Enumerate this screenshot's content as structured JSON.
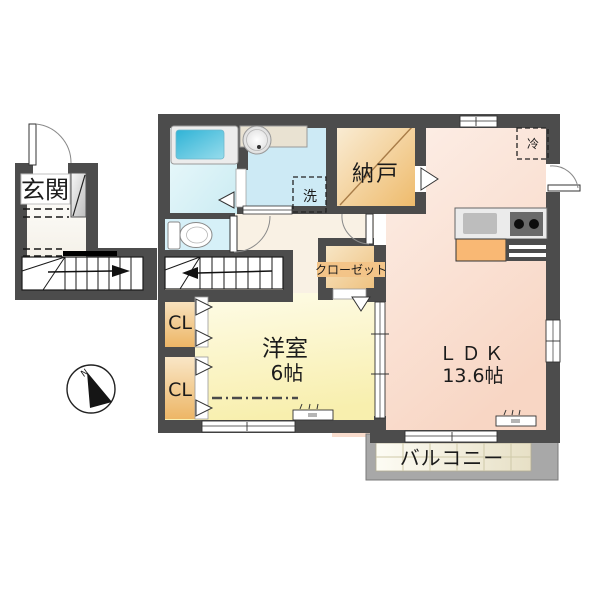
{
  "floor_plan": {
    "rooms": {
      "entrance": {
        "label": "玄関"
      },
      "storage": {
        "label": "納戸"
      },
      "closet": {
        "label": "クローゼット"
      },
      "closet_upper": {
        "label": "CL"
      },
      "closet_lower": {
        "label": "CL"
      },
      "western_room": {
        "label": "洋室",
        "size": "6帖"
      },
      "ldk": {
        "label": "ＬＤＫ",
        "size": "13.6帖"
      },
      "balcony": {
        "label": "バルコニー"
      }
    },
    "fixtures": {
      "washing_machine": {
        "label": "洗"
      },
      "refrigerator": {
        "label": "冷"
      }
    },
    "compass": {
      "north_label": "N"
    }
  },
  "colors": {
    "wall": "#4c4c4c",
    "balcony_wall": "#a8a8a8",
    "bathtub": "#35b6d6",
    "bathroom_floor": "#d9f1f5",
    "washroom_floor": "#cdeaf5",
    "toilet_floor": "#d6f0f8",
    "storage_room": "#f2c57e",
    "western_room": "#faf2b8",
    "ldk_floor": "#f9dcca",
    "hallway_floor": "#f9f1e4",
    "kitchen_counter_accent": "#f9b874",
    "closet_label_bg": "#f3c488"
  }
}
